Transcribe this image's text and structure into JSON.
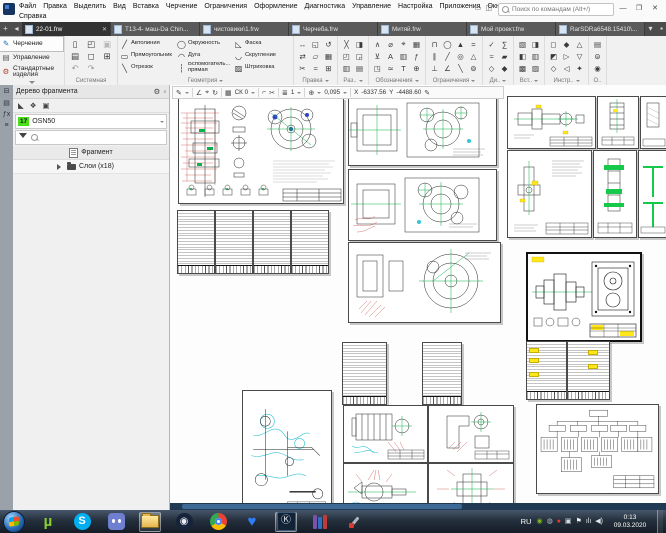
{
  "titlebar": {
    "search_placeholder": "Поиск по командам (Alt+/)",
    "min_glyph": "—",
    "restore_glyph": "❐",
    "close_glyph": "✕",
    "aux_icons": [
      {
        "name": "interface-scheme-icon",
        "glyph": "▭"
      },
      {
        "name": "screens-icon",
        "glyph": "◫"
      }
    ]
  },
  "menubar": {
    "items": [
      {
        "name": "menu-file",
        "label": "Файл"
      },
      {
        "name": "menu-edit",
        "label": "Правка"
      },
      {
        "name": "menu-select",
        "label": "Выделить"
      },
      {
        "name": "menu-view",
        "label": "Вид"
      },
      {
        "name": "menu-insert",
        "label": "Вставка"
      },
      {
        "name": "menu-draw",
        "label": "Черчение"
      },
      {
        "name": "menu-constraints",
        "label": "Ограничения"
      },
      {
        "name": "menu-styling",
        "label": "Оформление"
      },
      {
        "name": "menu-diagnostics",
        "label": "Диагностика"
      },
      {
        "name": "menu-manage",
        "label": "Управление"
      },
      {
        "name": "menu-settings",
        "label": "Настройка"
      },
      {
        "name": "menu-apps",
        "label": "Приложения"
      },
      {
        "name": "menu-window",
        "label": "Окно"
      }
    ],
    "row2": [
      {
        "name": "menu-help",
        "label": "Справка"
      }
    ]
  },
  "tabbar": {
    "add_glyph": "+",
    "prev_glyph": "◂",
    "list_glyph": "▾",
    "pin_glyph": "▪",
    "close_glyph": "✕",
    "tabs": [
      {
        "label": "22-01.frw"
      },
      {
        "label": "T13-4- маш-Da Chin..."
      },
      {
        "label": "чистовики\\1.frw"
      },
      {
        "label": "Черчеба.frw"
      },
      {
        "label": "Митяй.frw"
      },
      {
        "label": "Мой проект.frw"
      },
      {
        "label": "RarSDRa6548.15410\\..."
      }
    ]
  },
  "ribbon": {
    "modes": [
      {
        "name": "mode-drawing",
        "label": "Черчение",
        "glyph": "✎"
      },
      {
        "name": "mode-management",
        "label": "Управление",
        "glyph": "▤"
      },
      {
        "name": "mode-standard-parts",
        "label": "Стандартные изделия",
        "glyph": "⚙"
      }
    ],
    "system": {
      "label": "Системная",
      "icons": [
        {
          "name": "new-document-icon",
          "glyph": "▯"
        },
        {
          "name": "open-document-icon",
          "glyph": "◰"
        },
        {
          "name": "save-icon",
          "glyph": "▣",
          "color": "#b8b8b8"
        },
        {
          "name": "print-icon",
          "glyph": "▤"
        },
        {
          "name": "preview-icon",
          "glyph": "◻"
        },
        {
          "name": "save-all-icon",
          "glyph": "⊞"
        },
        {
          "name": "undo-icon",
          "glyph": "↶",
          "color": "#9a9a9a"
        },
        {
          "name": "redo-icon",
          "glyph": "↷",
          "color": "#9a9a9a"
        }
      ]
    },
    "geometry": {
      "label": "Геометрия",
      "tools": [
        {
          "name": "autoline",
          "label": "Автолиния",
          "glyph": "╱"
        },
        {
          "name": "rectangle",
          "label": "Прямоугольник",
          "glyph": "▭"
        },
        {
          "name": "segment",
          "label": "Отрезок",
          "glyph": "╲"
        },
        {
          "name": "circle",
          "label": "Окружность",
          "glyph": "◯"
        },
        {
          "name": "arc",
          "label": "Дуга",
          "glyph": "◠"
        },
        {
          "name": "aux-line",
          "label": "Вспомогатель... прямая",
          "glyph": "┆"
        },
        {
          "name": "chamfer",
          "label": "Фаска",
          "glyph": "◺"
        },
        {
          "name": "fillet",
          "label": "Скругление",
          "glyph": "◡"
        },
        {
          "name": "hatch",
          "label": "Штриховка",
          "glyph": "▨"
        }
      ]
    },
    "groups": [
      {
        "label": "Правка",
        "icons": [
          {
            "name": "move-icon",
            "glyph": "↔"
          },
          {
            "name": "copy-icon",
            "glyph": "⇄"
          },
          {
            "name": "trim-icon",
            "glyph": "✂"
          },
          {
            "name": "mirror-icon",
            "glyph": "◱"
          },
          {
            "name": "shear-icon",
            "glyph": "▱"
          },
          {
            "name": "deform-icon",
            "glyph": "≈"
          },
          {
            "name": "rotate-icon",
            "glyph": "↺"
          },
          {
            "name": "array-icon",
            "glyph": "▦"
          },
          {
            "name": "scale-icon",
            "glyph": "⊞"
          }
        ]
      },
      {
        "label": "Раз..",
        "icons": [
          {
            "name": "break-icon",
            "glyph": "╳"
          },
          {
            "name": "split-icon",
            "glyph": "◰"
          },
          {
            "name": "section-icon",
            "glyph": "▥"
          },
          {
            "name": "half-icon",
            "glyph": "◨"
          },
          {
            "name": "quarter-icon",
            "glyph": "◲"
          },
          {
            "name": "strip-icon",
            "glyph": "▤"
          }
        ]
      },
      {
        "label": "Обозначения",
        "icons": [
          {
            "name": "roughness-icon",
            "glyph": "∧"
          },
          {
            "name": "datum-icon",
            "glyph": "⊻"
          },
          {
            "name": "leader-icon",
            "glyph": "◳"
          },
          {
            "name": "diameter-mark-icon",
            "glyph": "⌀"
          },
          {
            "name": "text-a-icon",
            "glyph": "A"
          },
          {
            "name": "equal-mark-icon",
            "glyph": "≃"
          },
          {
            "name": "center-mark-icon",
            "glyph": "⌖"
          },
          {
            "name": "mark-table-icon",
            "glyph": "▥"
          },
          {
            "name": "text-icon",
            "glyph": "T"
          },
          {
            "name": "table-icon",
            "glyph": "▦"
          },
          {
            "name": "formula-icon",
            "glyph": "ƒ"
          },
          {
            "name": "base-icon",
            "glyph": "⊕"
          }
        ]
      },
      {
        "label": "Ограничения",
        "icons": [
          {
            "name": "coincident-icon",
            "glyph": "⊓"
          },
          {
            "name": "parallel-icon",
            "glyph": "∥"
          },
          {
            "name": "perpendicular-icon",
            "glyph": "⊥"
          },
          {
            "name": "tangent-icon",
            "glyph": "◯"
          },
          {
            "name": "angle-line-icon",
            "glyph": "╱"
          },
          {
            "name": "angle-icon",
            "glyph": "∠"
          },
          {
            "name": "fix-icon",
            "glyph": "▲"
          },
          {
            "name": "concentric-icon",
            "glyph": "◎"
          },
          {
            "name": "slope-icon",
            "glyph": "╲"
          },
          {
            "name": "equal-icon",
            "glyph": "="
          },
          {
            "name": "symmetry-icon",
            "glyph": "△"
          },
          {
            "name": "align-icon",
            "glyph": "⊚"
          }
        ]
      },
      {
        "label": "Ди..",
        "icons": [
          {
            "name": "check-icon",
            "glyph": "✓"
          },
          {
            "name": "wave-icon",
            "glyph": "≈"
          },
          {
            "name": "diamond-icon",
            "glyph": "◇"
          },
          {
            "name": "sum-icon",
            "glyph": "∑"
          },
          {
            "name": "bar-icon",
            "glyph": "▰"
          },
          {
            "name": "solid-diamond-icon",
            "glyph": "◆"
          }
        ]
      },
      {
        "label": "Вст..",
        "icons": [
          {
            "name": "insert-fragment-icon",
            "glyph": "▧"
          },
          {
            "name": "insert-view-icon",
            "glyph": "◧"
          },
          {
            "name": "insert-picture-icon",
            "glyph": "▩"
          },
          {
            "name": "insert-object-icon",
            "glyph": "◨"
          },
          {
            "name": "insert-table-icon",
            "glyph": "▥"
          },
          {
            "name": "insert-hatch-icon",
            "glyph": "▨"
          }
        ]
      },
      {
        "label": "Инстр..",
        "icons": [
          {
            "name": "tool-a-icon",
            "glyph": "◻"
          },
          {
            "name": "tool-b-icon",
            "glyph": "◩"
          },
          {
            "name": "tool-c-icon",
            "glyph": "◇"
          },
          {
            "name": "tool-d-icon",
            "glyph": "◆"
          },
          {
            "name": "tool-e-icon",
            "glyph": "▷"
          },
          {
            "name": "tool-f-icon",
            "glyph": "◁"
          },
          {
            "name": "tool-g-icon",
            "glyph": "△"
          },
          {
            "name": "tool-h-icon",
            "glyph": "▽"
          },
          {
            "name": "tool-i-icon",
            "glyph": "✦"
          }
        ]
      },
      {
        "label": "О..",
        "icons": [
          {
            "name": "panel-a-icon",
            "glyph": "▤"
          },
          {
            "name": "panel-b-icon",
            "glyph": "⊜"
          },
          {
            "name": "panel-c-icon",
            "glyph": "◉"
          }
        ]
      }
    ]
  },
  "tree": {
    "title": "Дерево фрагмента",
    "gear_glyph": "⚙",
    "dock_glyph": "▫",
    "panelbar": [
      {
        "name": "parameters-panel-icon",
        "glyph": "⊟"
      },
      {
        "name": "list-panel-icon",
        "glyph": "▤"
      },
      {
        "name": "variables-panel-icon",
        "glyph": "ƒx"
      },
      {
        "name": "menu-panel-icon",
        "glyph": "≡"
      }
    ],
    "tools": [
      {
        "name": "draw-mode-icon",
        "glyph": "◣"
      },
      {
        "name": "layers-view-icon",
        "glyph": "❖"
      },
      {
        "name": "preview-pane-icon",
        "glyph": "▣"
      }
    ],
    "layer_number": "17",
    "layer_name": "OSN50",
    "root_label": "Фрагмент",
    "layers_label": "Слои (x18)"
  },
  "canvas": {
    "toolbar": {
      "icons": {
        "pencil": "✎",
        "angle": "∠",
        "snap": "⌖",
        "refresh": "↻",
        "grid": "▦",
        "corner": "⌐",
        "scissors": "✂",
        "layers": "≣",
        "zoom": "⊕"
      },
      "cs": "СК 0",
      "layer": "1",
      "zoom": "0,095",
      "x_label": "X",
      "x": "-6337.56",
      "y_label": "Y",
      "y": "-4488.60"
    }
  },
  "taskbar": {
    "lang": "RU",
    "time": "0:13",
    "date": "09.03.2020",
    "apps": [
      "start",
      "utorrent",
      "skype",
      "discord",
      "explorer",
      "steam",
      "chrome",
      "heart-app",
      "kompas",
      "winrar",
      "tool-utility"
    ],
    "tray": [
      {
        "name": "nvidia-tray-icon",
        "glyph": "◉",
        "color": "#7ab520"
      },
      {
        "name": "update-tray-icon",
        "glyph": "◍",
        "color": "#b9bec4"
      },
      {
        "name": "antivirus-tray-icon",
        "glyph": "●",
        "color": "#e33c2e"
      },
      {
        "name": "network-tray-icon",
        "glyph": "▣",
        "color": "#d7dde2"
      },
      {
        "name": "action-center-flag-icon",
        "glyph": "⚑",
        "color": "#eef2f5"
      },
      {
        "name": "signal-tray-icon",
        "glyph": "ılı",
        "color": "#dfe5ea"
      },
      {
        "name": "volume-tray-icon",
        "glyph": "◀)",
        "color": "#dfe5ea"
      }
    ]
  }
}
